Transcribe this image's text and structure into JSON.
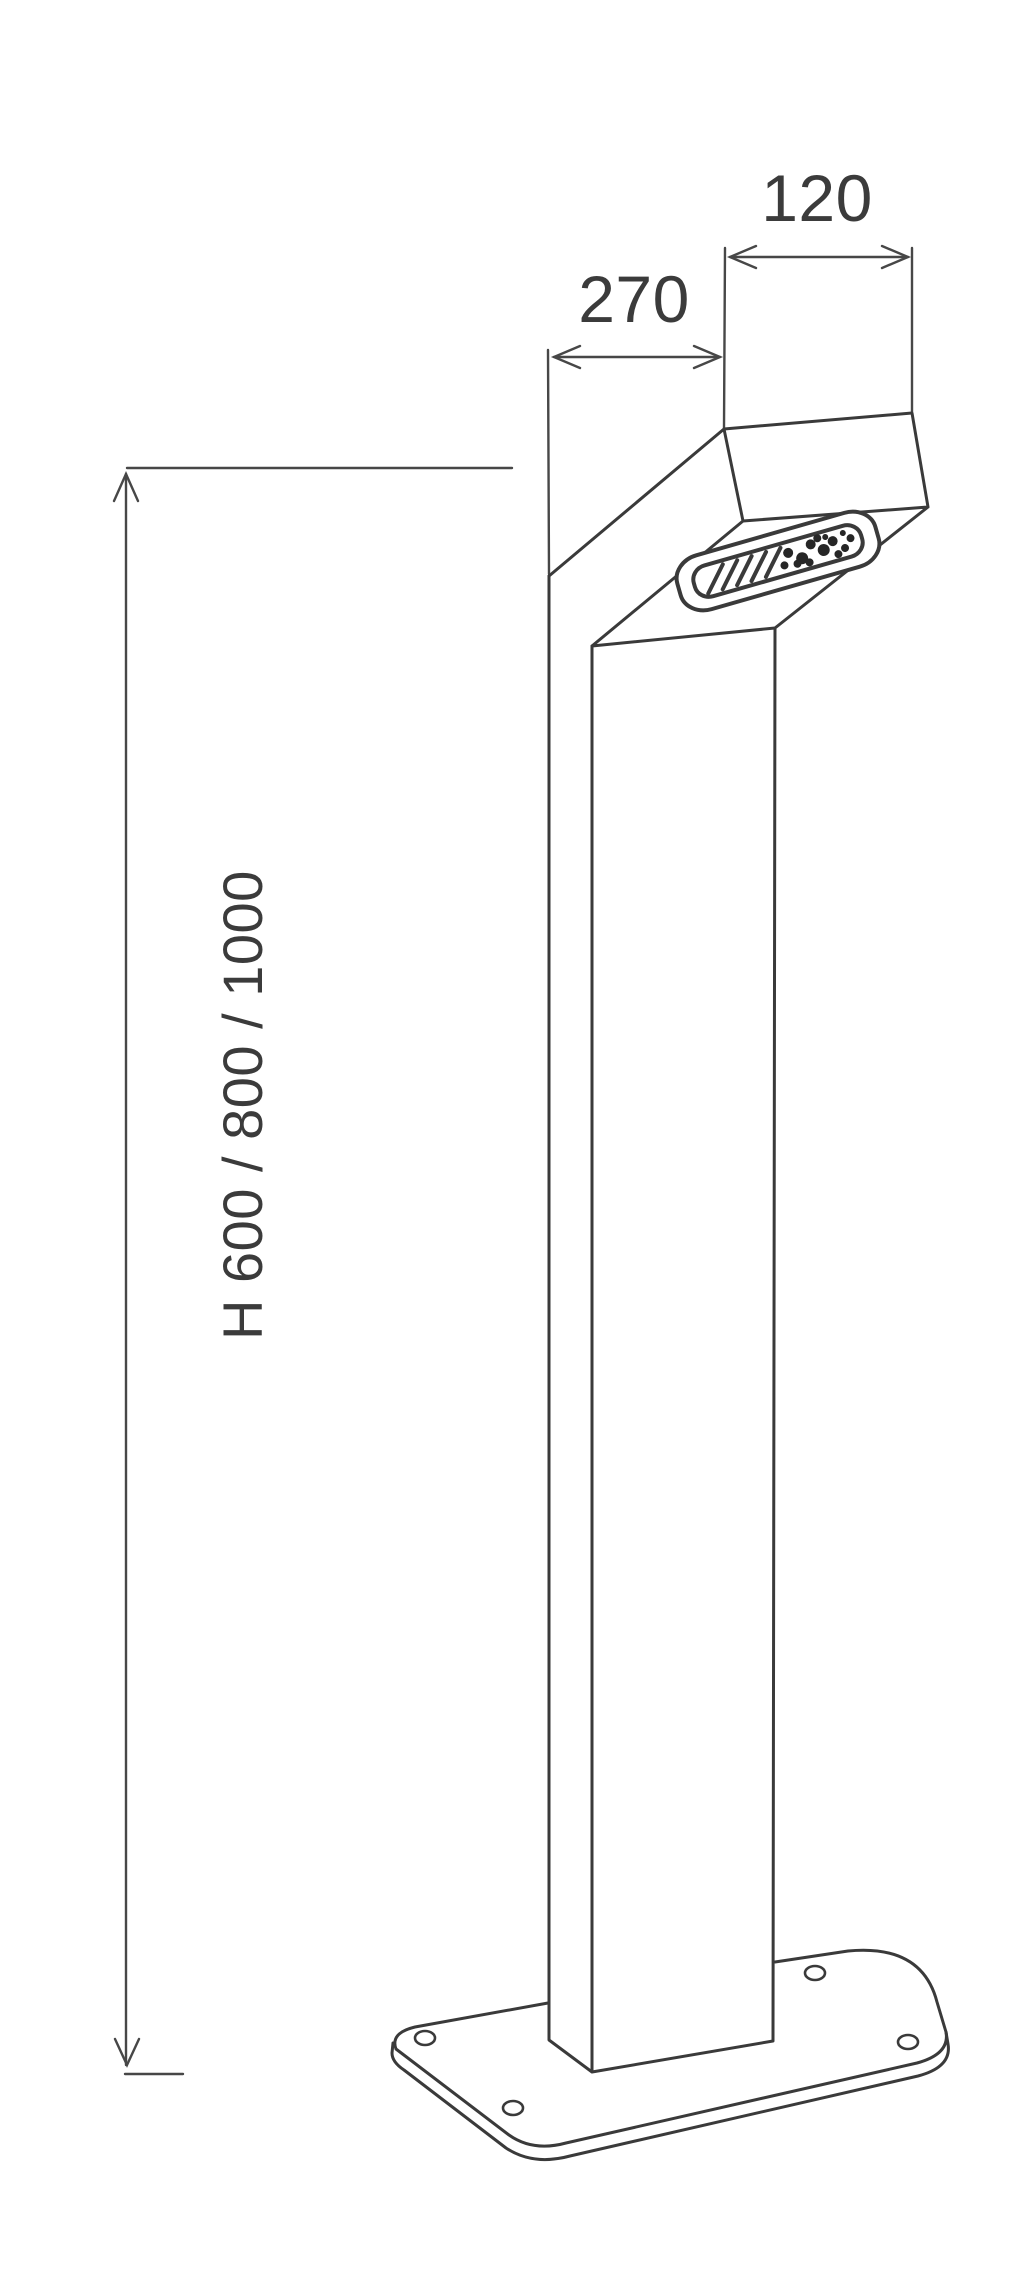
{
  "canvas": {
    "width": 1030,
    "height": 2283
  },
  "colors": {
    "background": "#ffffff",
    "line": "#3a3a3a",
    "dim": "#474747",
    "text": "#3b3b3b",
    "blob": "#262626"
  },
  "drawing": {
    "kind": "dimensioned technical line drawing of a bollard light fixture",
    "labels": {
      "head_width": "120",
      "head_depth": "270",
      "height_options": "H 600 / 800 / 1000"
    }
  }
}
